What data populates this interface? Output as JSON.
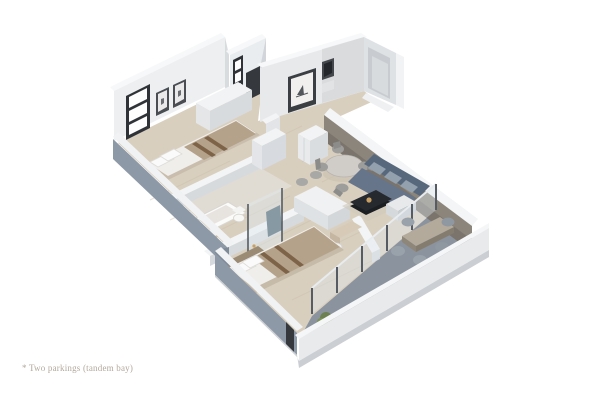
{
  "caption": {
    "text": "* Two parkings (tandem bay)"
  },
  "colors": {
    "background": "#ffffff",
    "floor_wood": "#d9cfbf",
    "floor_bath": "#e1dcd3",
    "floor_balcony": "#8b939e",
    "wall_face": "#edeff1",
    "wall_face_back": "#e7e9eb",
    "wall_top": "#f7f8f9",
    "wall_shade": "#d9dcdf",
    "wall_exterior_blue": "#8e99a7",
    "wall_accent": "#8b857b",
    "glass": "#dfe9f0",
    "window_frame": "#2f3337",
    "door_opening": "#35393d",
    "sofa": "#66758a",
    "sofa_back": "#57687c",
    "coffee_table": "#26292d",
    "bed_blanket": "#b5a28a",
    "bed_stripe": "#7d6348",
    "mattress": "#f0eeea",
    "dining_table": "#d0cdc8",
    "chair_gray": "#9d9d9b",
    "outdoor_table": "#b3aa9c",
    "plant": "#6d8150",
    "gold_fixture": "#c9a063",
    "teal_accent": "#3e5a66",
    "caption_text": "#b3a89c"
  }
}
